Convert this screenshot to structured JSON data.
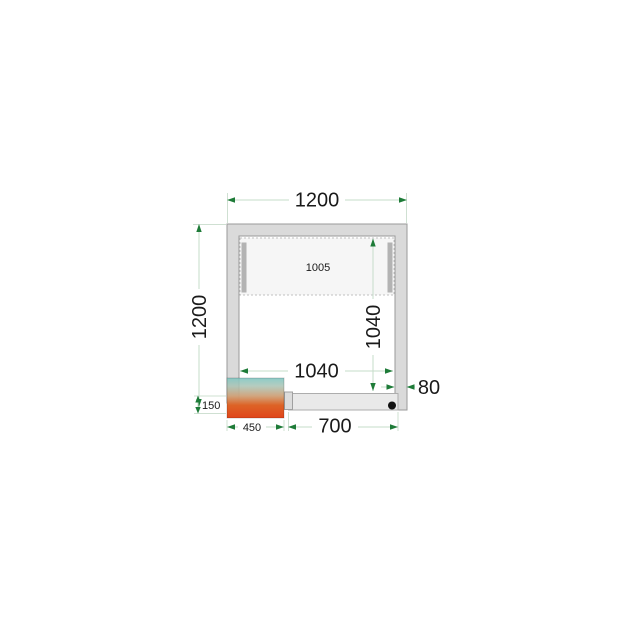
{
  "drawing": {
    "type": "cold-room-floor-plan",
    "dimensions": {
      "top_width": "1200",
      "side_height": "1200",
      "top_zone_width": "1005",
      "inner_height": "1040",
      "inner_width": "1040",
      "wall_thickness": "80",
      "unit_offset": "150",
      "unit_width": "450",
      "door_width": "700"
    },
    "colors": {
      "wall_fill": "#dadada",
      "wall_stroke": "#9a9a9a",
      "door_fill": "#e9e9e9",
      "dimension_line": "#c6dcca",
      "dimension_arrow_green": "#1e7b38",
      "unit_gradient_top": "#7fc6c2",
      "unit_gradient_bottom": "#e0451a",
      "text": "#1a1a1a"
    }
  }
}
